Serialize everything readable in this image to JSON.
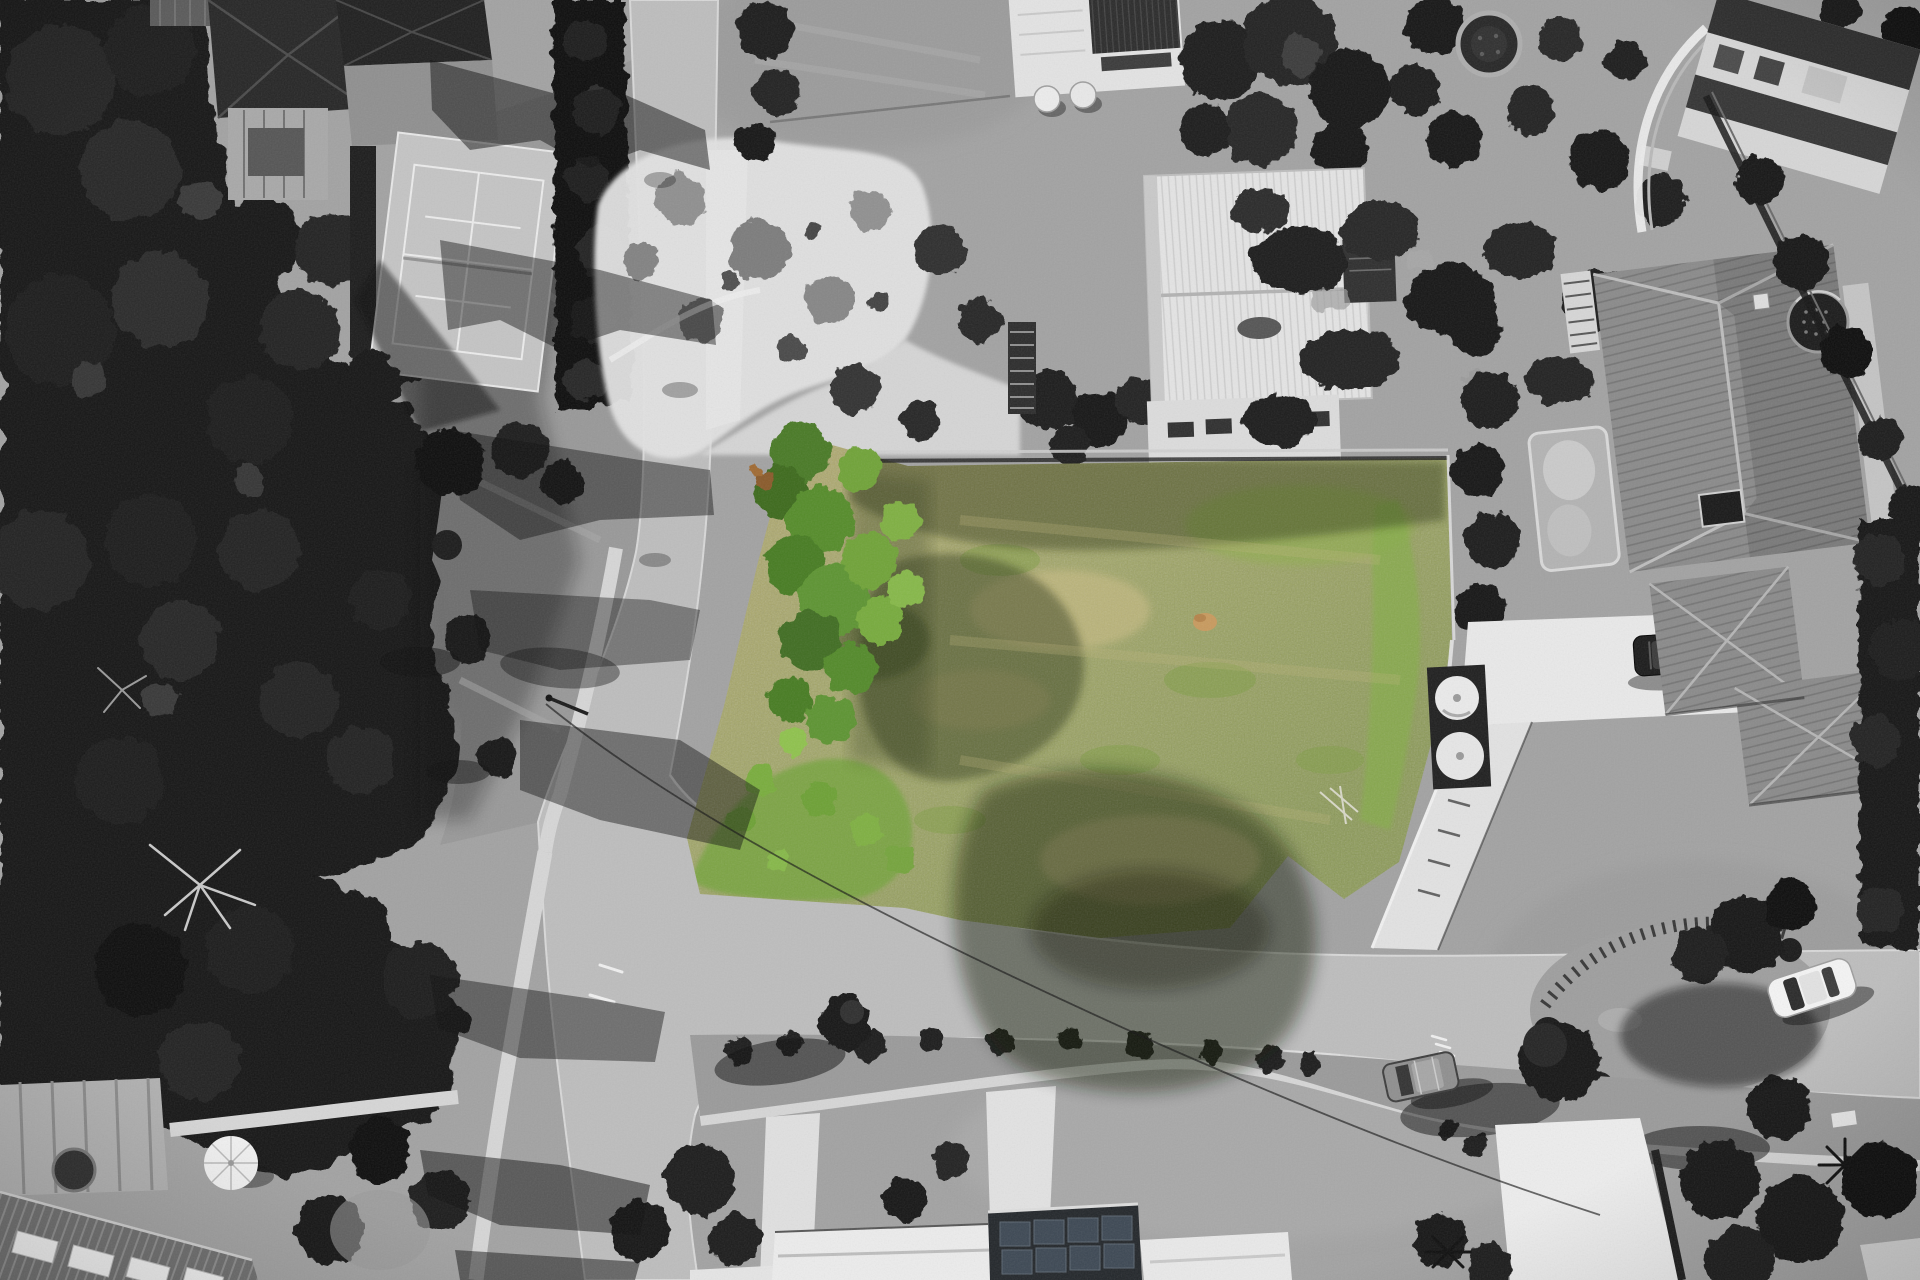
{
  "scene": {
    "type": "aerial-drone-photograph",
    "treatment": "selective colour: vacant land parcel shown in colour, all surroundings desaturated black and white",
    "subject": "vacant corner block of residential land surrounded by suburban houses, streets and dense trees",
    "view": "top-down nadir drone view"
  },
  "palette": {
    "ground": "#a2a2a2",
    "forest_dark": "#131313",
    "tree_crown": "#262626",
    "road": "#bdbdbd",
    "footpath": "#d6d6d6",
    "white_paving": "#e2e2e2",
    "court_surface": "#c4c4c4",
    "court_lines": "#ececec",
    "dark_roof": "#262626",
    "ribbed_roof_white": "#e4e4e4",
    "tile_roof": "#8a8a8a",
    "driveway_white": "#e9e9e9",
    "lot_grass_light": "#b0a96f",
    "lot_grass_mid": "#9ea465",
    "lot_grass_deep": "#8c9a57",
    "lot_green_bright": "#74a43c",
    "lot_tree_green": "#4a7a28",
    "lot_dry_pale": "#cbbd86",
    "lot_shadow_olive": "#222c10",
    "rust_shrub": "#8a5a2a",
    "white_car": "#f4f4f4",
    "dark_car": "#1b1b1b",
    "gray_car": "#8f8f8f",
    "shadow": "#0d0d0d"
  },
  "features": {
    "highlighted_lot": {
      "name": "vacant-lot",
      "state": "colour-highlighted",
      "vegetation": "dry olive grass, green trees along west edge, bright green shrubs near street"
    },
    "roads": [
      "street entering at top centre-left running down to a junction",
      "street sweeping right from junction to the right edge",
      "street exiting bottom-left"
    ],
    "vehicles": [
      {
        "name": "white-car",
        "location": "parked on street, lower right"
      },
      {
        "name": "dark-car",
        "location": "driveway of tiled-roof house, right"
      },
      {
        "name": "grey-car",
        "location": "parked on street, bottom centre-left"
      }
    ],
    "structures": [
      "tennis-court top-left",
      "dark-roof-house top-left",
      "garden-with-white-paths top centre",
      "flat-roof-house-with-solar-panels top centre",
      "white-ribbed-roof-modern-house top centre",
      "tiled-roof-house right",
      "swimming-pool",
      "trampoline",
      "water-tanks",
      "round-spa top right",
      "house-with-solar-panel-roof bottom",
      "white-gable-roofs bottom",
      "corrugated-roof-house bottom-left",
      "patio-deck-with-umbrella bottom-left"
    ]
  }
}
